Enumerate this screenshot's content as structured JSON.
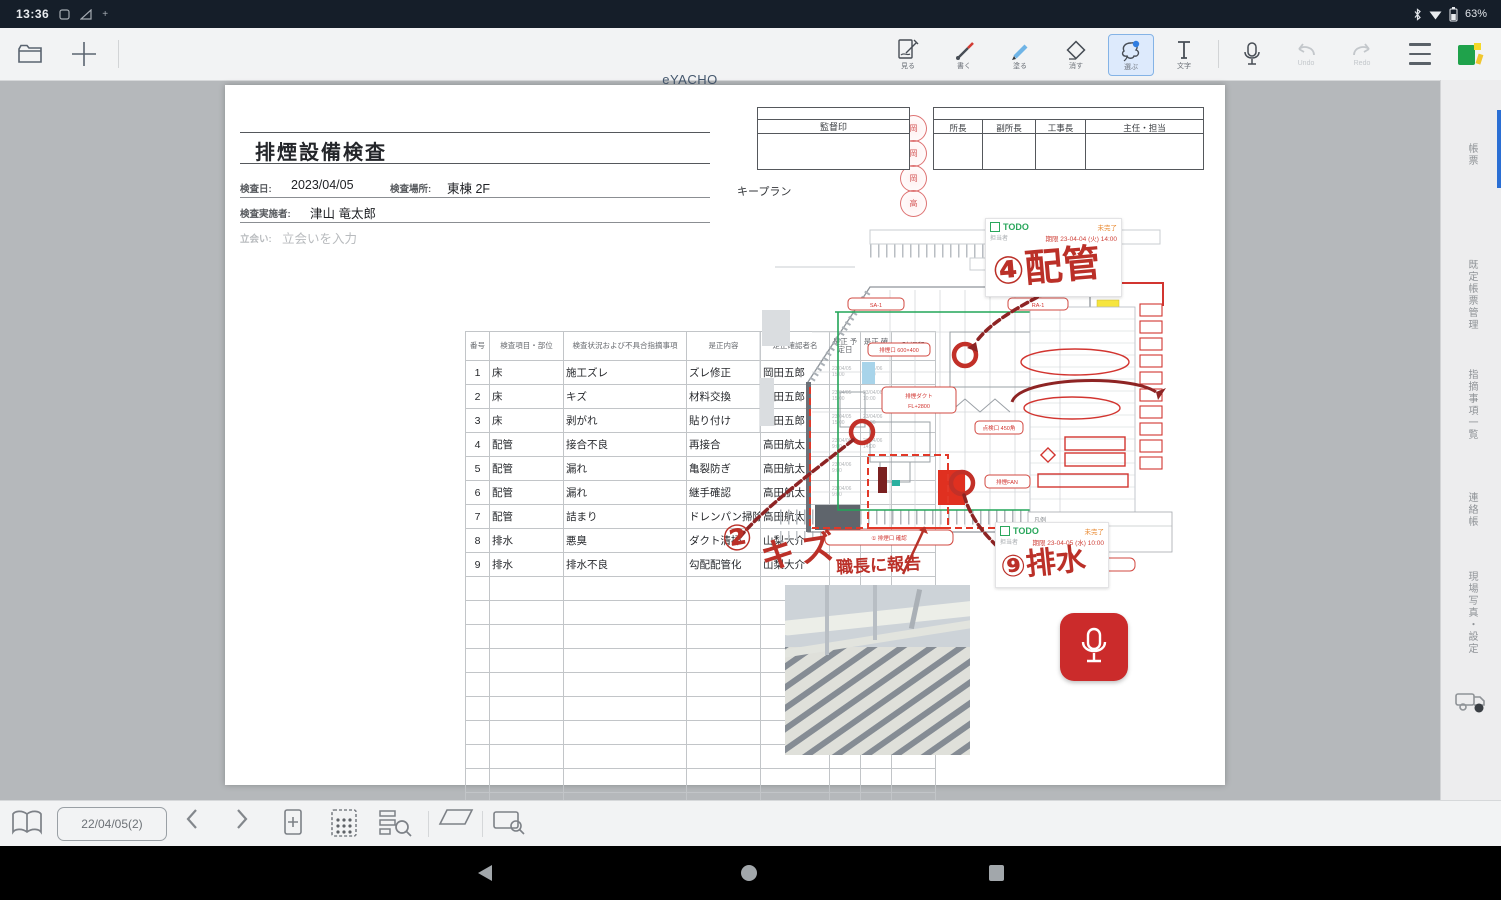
{
  "status_bar": {
    "time": "13:36",
    "battery_percent": "63%"
  },
  "toolbar": {
    "app_title": "eYACHO",
    "tools": [
      {
        "label": "見る"
      },
      {
        "label": "書く"
      },
      {
        "label": "塗る"
      },
      {
        "label": "消す"
      },
      {
        "label": "選ぶ"
      },
      {
        "label": "文字"
      }
    ],
    "selected_tool_index": 4,
    "undo_label": "Undo",
    "redo_label": "Redo"
  },
  "document": {
    "title": "排煙設備検査",
    "fields": {
      "date_label": "検査日:",
      "date_value": "2023/04/05",
      "place_label": "検査場所:",
      "place_value": "東棟 2F",
      "inspector_label": "検査実施者:",
      "inspector_value": "津山 竜太郎",
      "witness_label": "立会い:",
      "witness_placeholder": "立会いを入力"
    },
    "table": {
      "headers": [
        "番号",
        "検査項目・部位",
        "検査状況および不具合指摘事項",
        "是正内容",
        "是正確認者名",
        "是正 予定日",
        "是正 確認日",
        "確認印"
      ],
      "rows": [
        {
          "no": "1",
          "part": "床",
          "issue": "施工ズレ",
          "fix": "ズレ修正",
          "name": "岡田五郎",
          "d1": "23/04/05 15:00",
          "d2": "23/04/06 10:00",
          "stamp": "岡"
        },
        {
          "no": "2",
          "part": "床",
          "issue": "キズ",
          "fix": "材料交換",
          "name": "岡田五郎",
          "d1": "23/04/05 15:00",
          "d2": "23/04/06 10:00",
          "stamp": "岡"
        },
        {
          "no": "3",
          "part": "床",
          "issue": "剥がれ",
          "fix": "貼り付け",
          "name": "岡田五郎",
          "d1": "23/04/05 15:00",
          "d2": "23/04/06 10:00",
          "stamp": "岡"
        },
        {
          "no": "4",
          "part": "配管",
          "issue": "接合不良",
          "fix": "再接合",
          "name": "高田航太",
          "d1": "23/04/06 9:00",
          "d2": "23/04/06 14:00",
          "stamp": "高"
        },
        {
          "no": "5",
          "part": "配管",
          "issue": "漏れ",
          "fix": "亀裂防ぎ",
          "name": "高田航太",
          "d1": "23/04/06 9:00",
          "d2": "",
          "stamp": ""
        },
        {
          "no": "6",
          "part": "配管",
          "issue": "漏れ",
          "fix": "継手確認",
          "name": "高田航太",
          "d1": "23/04/06 9:00",
          "d2": "",
          "stamp": ""
        },
        {
          "no": "7",
          "part": "配管",
          "issue": "詰まり",
          "fix": "ドレンパン掃除",
          "name": "高田航太",
          "d1": "23/04/06 9:00",
          "d2": "",
          "stamp": ""
        },
        {
          "no": "8",
          "part": "排水",
          "issue": "悪臭",
          "fix": "ダクト清掃",
          "name": "山梨大介",
          "d1": "",
          "d2": "",
          "stamp": ""
        },
        {
          "no": "9",
          "part": "排水",
          "issue": "排水不良",
          "fix": "勾配配管化",
          "name": "山梨大介",
          "d1": "",
          "d2": "",
          "stamp": ""
        }
      ],
      "empty_row_count": 11
    },
    "supervisor_box_title": "監督印",
    "approval_columns": [
      "所長",
      "副所長",
      "工事長",
      "主任・担当"
    ],
    "keyplan_label": "キープラン",
    "notes": [
      {
        "todo_label": "TODO",
        "status": "未完了",
        "assignee": "担当者",
        "due": "期限 23-04-04 (火) 14:00"
      },
      {
        "todo_label": "TODO",
        "status": "未完了",
        "assignee": "担当者",
        "due": "期限 23-04-05 (水) 10:00"
      }
    ],
    "handwriting": {
      "pipe": "④配管",
      "scratch_no": "②",
      "scratch": "キズ",
      "report": "職長に報告",
      "drain": "⑨排水"
    },
    "plan_labels": {
      "l1": "排煙口 600×400",
      "l2a": "排煙ダクト",
      "l2b": "FL+2800",
      "l3": "点検口 450角",
      "l4": "排煙FAN",
      "l5a": "SA-1",
      "l5b": "RA-1",
      "b1": "① 排煙口 確認",
      "b2": "② 風量測定",
      "b3": "排煙系統図 参照",
      "legend1": "凡例",
      "legend2": "排煙ダクト ルート"
    },
    "photo_caption": "追加"
  },
  "sidebar": {
    "tabs": [
      "帳票",
      "既定帳票管理",
      "指摘事項一覧",
      "連絡帳",
      "現場写真・設定"
    ]
  },
  "bottom_bar": {
    "date_chip": "22/04/05(2)"
  }
}
